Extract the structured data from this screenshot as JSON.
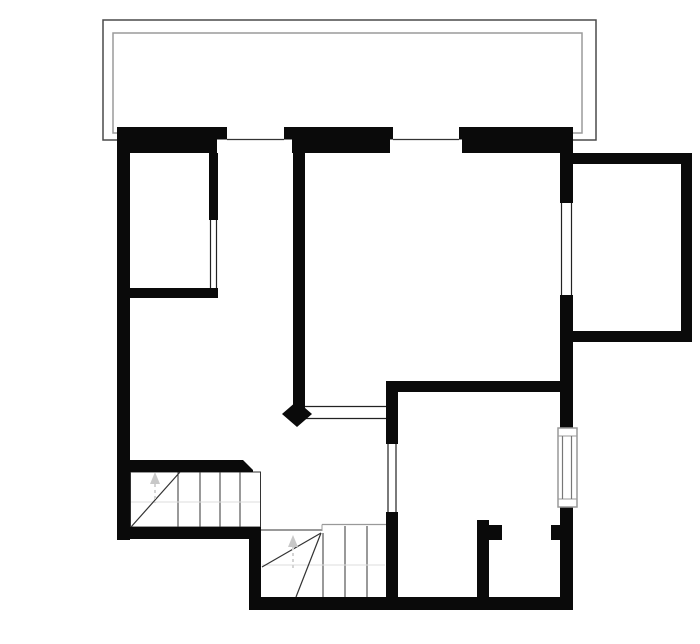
{
  "canvas": {
    "width": 700,
    "height": 644,
    "background": "#ffffff"
  },
  "colors": {
    "wall": "#0a0a0a",
    "balcony_outer": "#4a4a4a",
    "balcony_inner": "#9a9a9a",
    "stair_line": "#333333",
    "stair_faint": "#dddddd",
    "arrow": "#c8c8c8",
    "window_line": "#222222",
    "window_frame": "#999999",
    "glass": "#777777",
    "white": "#ffffff"
  },
  "floorplan": {
    "shapes": [
      {
        "t": "rect",
        "name": "balcony-outer-line",
        "x": 103,
        "y": 20,
        "w": 493,
        "h": 120,
        "stroke": "#4a4a4a",
        "sw": 1.5
      },
      {
        "t": "rect",
        "name": "balcony-inner-line",
        "x": 113,
        "y": 33,
        "w": 469,
        "h": 100,
        "stroke": "#9a9a9a",
        "sw": 1.5
      },
      {
        "t": "rect",
        "name": "stair-upper-outline",
        "x": 130.5,
        "y": 472,
        "w": 130,
        "h": 55,
        "stroke": "#333333",
        "sw": 1
      },
      {
        "t": "line",
        "name": "stair-upper-tread-1",
        "x1": 178,
        "y1": 472,
        "x2": 178,
        "y2": 527,
        "stroke": "#333333",
        "sw": 1
      },
      {
        "t": "line",
        "name": "stair-upper-tread-2",
        "x1": 200,
        "y1": 472,
        "x2": 200,
        "y2": 527,
        "stroke": "#333333",
        "sw": 1
      },
      {
        "t": "line",
        "name": "stair-upper-tread-3",
        "x1": 220,
        "y1": 472,
        "x2": 220,
        "y2": 527,
        "stroke": "#333333",
        "sw": 1
      },
      {
        "t": "line",
        "name": "stair-upper-tread-4",
        "x1": 240,
        "y1": 472,
        "x2": 240,
        "y2": 527,
        "stroke": "#333333",
        "sw": 1
      },
      {
        "t": "line",
        "name": "stair-upper-faint-line",
        "x1": 131,
        "y1": 502,
        "x2": 260,
        "y2": 502,
        "stroke": "#dddddd",
        "sw": 1
      },
      {
        "t": "line",
        "name": "stair-upper-winder-line",
        "x1": 131,
        "y1": 527,
        "x2": 180,
        "y2": 472,
        "stroke": "#333333",
        "sw": 1.2
      },
      {
        "t": "poly",
        "name": "stair-upper-direction-arrow-icon",
        "points": "155,472 150,484 160,484",
        "fill": "#c8c8c8"
      },
      {
        "t": "line",
        "name": "stair-upper-arrow-stem",
        "x1": 155,
        "y1": 484,
        "x2": 155,
        "y2": 503,
        "stroke": "#d4d4d4",
        "sw": 2,
        "dash": "3 3"
      },
      {
        "t": "line",
        "name": "stair-lower-top-edge-left",
        "x1": 261,
        "y1": 530,
        "x2": 322,
        "y2": 530,
        "stroke": "#333333",
        "sw": 1
      },
      {
        "t": "line",
        "name": "stair-lower-top-edge-right",
        "x1": 322,
        "y1": 524.5,
        "x2": 386,
        "y2": 524.5,
        "stroke": "#999999",
        "sw": 1.2
      },
      {
        "t": "line",
        "name": "stair-lower-top-step",
        "x1": 322,
        "y1": 524.5,
        "x2": 322,
        "y2": 531,
        "stroke": "#999999",
        "sw": 1
      },
      {
        "t": "line",
        "name": "stair-lower-tread-1",
        "x1": 323,
        "y1": 533,
        "x2": 323,
        "y2": 597,
        "stroke": "#333333",
        "sw": 1
      },
      {
        "t": "line",
        "name": "stair-lower-tread-2",
        "x1": 345,
        "y1": 526,
        "x2": 345,
        "y2": 597,
        "stroke": "#333333",
        "sw": 1
      },
      {
        "t": "line",
        "name": "stair-lower-tread-3",
        "x1": 367,
        "y1": 526,
        "x2": 367,
        "y2": 597,
        "stroke": "#333333",
        "sw": 1
      },
      {
        "t": "line",
        "name": "stair-lower-faint-line",
        "x1": 262,
        "y1": 565,
        "x2": 385,
        "y2": 565,
        "stroke": "#dddddd",
        "sw": 1
      },
      {
        "t": "line",
        "name": "stair-lower-winder-line-1",
        "x1": 321,
        "y1": 533,
        "x2": 262,
        "y2": 567,
        "stroke": "#333333",
        "sw": 1.2
      },
      {
        "t": "line",
        "name": "stair-lower-winder-line-2",
        "x1": 321,
        "y1": 533,
        "x2": 296,
        "y2": 597,
        "stroke": "#333333",
        "sw": 1.2
      },
      {
        "t": "poly",
        "name": "stair-lower-direction-arrow-icon",
        "points": "293,535 288,547 298,547",
        "fill": "#c8c8c8"
      },
      {
        "t": "line",
        "name": "stair-lower-arrow-stem",
        "x1": 293,
        "y1": 547,
        "x2": 293,
        "y2": 571,
        "stroke": "#d4d4d4",
        "sw": 2,
        "dash": "3 3"
      },
      {
        "t": "rect",
        "name": "wall-top-exterior",
        "x": 117,
        "y": 127,
        "w": 456,
        "h": 26,
        "fill": "#0a0a0a"
      },
      {
        "t": "rect",
        "name": "wall-left-exterior",
        "x": 117,
        "y": 127,
        "w": 13,
        "h": 413,
        "fill": "#0a0a0a"
      },
      {
        "t": "rect",
        "name": "wall-room1-right",
        "x": 209,
        "y": 153,
        "w": 9,
        "h": 67,
        "fill": "#0a0a0a"
      },
      {
        "t": "rect",
        "name": "wall-room1-bottom",
        "x": 128,
        "y": 288,
        "w": 90,
        "h": 10,
        "fill": "#0a0a0a"
      },
      {
        "t": "rect",
        "name": "wall-middle-vertical",
        "x": 293,
        "y": 153,
        "w": 12,
        "h": 255,
        "fill": "#0a0a0a"
      },
      {
        "t": "poly",
        "name": "wall-stair-top",
        "points": "117,460 243,460 253,470 253,472 117,472",
        "fill": "#0a0a0a"
      },
      {
        "t": "rect",
        "name": "wall-lowerleft-horizontal",
        "x": 117,
        "y": 527,
        "w": 144,
        "h": 12,
        "fill": "#0a0a0a"
      },
      {
        "t": "rect",
        "name": "wall-lowerleft-vertical",
        "x": 249,
        "y": 527,
        "w": 12,
        "h": 83,
        "fill": "#0a0a0a"
      },
      {
        "t": "rect",
        "name": "wall-bottom-exterior",
        "x": 249,
        "y": 597,
        "w": 324,
        "h": 13,
        "fill": "#0a0a0a"
      },
      {
        "t": "rect",
        "name": "wall-bedroom-top",
        "x": 386,
        "y": 381,
        "w": 187,
        "h": 11,
        "fill": "#0a0a0a"
      },
      {
        "t": "rect",
        "name": "wall-bedroom-left-upper",
        "x": 386,
        "y": 381,
        "w": 12,
        "h": 63,
        "fill": "#0a0a0a"
      },
      {
        "t": "rect",
        "name": "wall-bedroom-left-lower",
        "x": 386,
        "y": 512,
        "w": 12,
        "h": 98,
        "fill": "#0a0a0a"
      },
      {
        "t": "rect",
        "name": "wall-right-upper",
        "x": 560,
        "y": 127,
        "w": 13,
        "h": 76,
        "fill": "#0a0a0a"
      },
      {
        "t": "rect",
        "name": "wall-right-middle",
        "x": 560,
        "y": 295,
        "w": 13,
        "h": 133,
        "fill": "#0a0a0a"
      },
      {
        "t": "rect",
        "name": "wall-right-lower",
        "x": 560,
        "y": 507,
        "w": 13,
        "h": 103,
        "fill": "#0a0a0a"
      },
      {
        "t": "rect",
        "name": "wall-right-door-stub",
        "x": 551,
        "y": 525,
        "w": 9,
        "h": 15,
        "fill": "#0a0a0a"
      },
      {
        "t": "rect",
        "name": "wall-partition",
        "x": 477,
        "y": 520,
        "w": 12,
        "h": 77,
        "fill": "#0a0a0a"
      },
      {
        "t": "rect",
        "name": "wall-partition-cap",
        "x": 489,
        "y": 525,
        "w": 13,
        "h": 15,
        "fill": "#0a0a0a"
      },
      {
        "t": "rect",
        "name": "wall-bay-top",
        "x": 573,
        "y": 153,
        "w": 119,
        "h": 11,
        "fill": "#0a0a0a"
      },
      {
        "t": "rect",
        "name": "wall-bay-right",
        "x": 681,
        "y": 153,
        "w": 11,
        "h": 189,
        "fill": "#0a0a0a"
      },
      {
        "t": "rect",
        "name": "wall-bay-bottom",
        "x": 573,
        "y": 331,
        "w": 119,
        "h": 11,
        "fill": "#0a0a0a"
      },
      {
        "t": "rect",
        "name": "window-top-left-outer-cut",
        "x": 227,
        "y": 127,
        "w": 57,
        "h": 12.5,
        "fill": "#ffffff"
      },
      {
        "t": "rect",
        "name": "window-top-left-inner-cut",
        "x": 217,
        "y": 139.5,
        "w": 75,
        "h": 13.5,
        "fill": "#ffffff"
      },
      {
        "t": "line",
        "name": "window-top-left-sill",
        "x1": 227,
        "y1": 139.5,
        "x2": 284,
        "y2": 139.5,
        "stroke": "#333333",
        "sw": 1.2
      },
      {
        "t": "rect",
        "name": "window-top-mid-outer-cut",
        "x": 393,
        "y": 127,
        "w": 66,
        "h": 12.5,
        "fill": "#ffffff"
      },
      {
        "t": "rect",
        "name": "window-top-mid-inner-cut",
        "x": 390,
        "y": 139.5,
        "w": 72,
        "h": 13.5,
        "fill": "#ffffff"
      },
      {
        "t": "line",
        "name": "window-top-mid-sill",
        "x1": 393,
        "y1": 139.5,
        "x2": 459,
        "y2": 139.5,
        "stroke": "#333333",
        "sw": 1.2
      },
      {
        "t": "rect",
        "name": "window-room1-cut",
        "x": 209,
        "y": 220,
        "w": 9,
        "h": 68,
        "fill": "#ffffff"
      },
      {
        "t": "line",
        "name": "window-room1-line-left",
        "x1": 210.5,
        "y1": 220,
        "x2": 210.5,
        "y2": 288,
        "stroke": "#222222",
        "sw": 1.2
      },
      {
        "t": "line",
        "name": "window-room1-line-right",
        "x1": 216.5,
        "y1": 220,
        "x2": 216.5,
        "y2": 288,
        "stroke": "#222222",
        "sw": 1.2
      },
      {
        "t": "rect",
        "name": "window-right-upper-cut",
        "x": 560,
        "y": 203,
        "w": 13,
        "h": 92,
        "fill": "#ffffff"
      },
      {
        "t": "line",
        "name": "window-right-upper-line-left",
        "x1": 561.5,
        "y1": 203,
        "x2": 561.5,
        "y2": 295,
        "stroke": "#222222",
        "sw": 1.2
      },
      {
        "t": "line",
        "name": "window-right-upper-line-right",
        "x1": 571.5,
        "y1": 203,
        "x2": 571.5,
        "y2": 295,
        "stroke": "#222222",
        "sw": 1.2
      },
      {
        "t": "rect",
        "name": "hall-opening-cut",
        "x": 305,
        "y": 405.5,
        "w": 81,
        "h": 14,
        "fill": "#ffffff"
      },
      {
        "t": "line",
        "name": "hall-opening-line-top",
        "x1": 305,
        "y1": 406.5,
        "x2": 386,
        "y2": 406.5,
        "stroke": "#222222",
        "sw": 1.2
      },
      {
        "t": "line",
        "name": "hall-opening-line-bottom",
        "x1": 305,
        "y1": 418.5,
        "x2": 386,
        "y2": 418.5,
        "stroke": "#222222",
        "sw": 1.2
      },
      {
        "t": "rect",
        "name": "window-bedroom-left-cut",
        "x": 386,
        "y": 444,
        "w": 12,
        "h": 68,
        "fill": "#ffffff"
      },
      {
        "t": "line",
        "name": "window-bedroom-left-line-a",
        "x1": 388,
        "y1": 444,
        "x2": 388,
        "y2": 512,
        "stroke": "#222222",
        "sw": 1.2
      },
      {
        "t": "line",
        "name": "window-bedroom-left-line-b",
        "x1": 396,
        "y1": 444,
        "x2": 396,
        "y2": 512,
        "stroke": "#222222",
        "sw": 1.2
      },
      {
        "t": "rect",
        "name": "window-right-lower-frame",
        "x": 558,
        "y": 428,
        "w": 19,
        "h": 79,
        "fill": "#ffffff",
        "stroke": "#999999",
        "sw": 1.5
      },
      {
        "t": "line",
        "name": "window-right-lower-cap-top",
        "x1": 558,
        "y1": 436,
        "x2": 577,
        "y2": 436,
        "stroke": "#999999",
        "sw": 1
      },
      {
        "t": "line",
        "name": "window-right-lower-cap-bottom",
        "x1": 558,
        "y1": 499,
        "x2": 577,
        "y2": 499,
        "stroke": "#999999",
        "sw": 1
      },
      {
        "t": "line",
        "name": "window-right-lower-glass-left",
        "x1": 562.5,
        "y1": 436,
        "x2": 562.5,
        "y2": 499,
        "stroke": "#777777",
        "sw": 1.2
      },
      {
        "t": "line",
        "name": "window-right-lower-glass-right",
        "x1": 571.5,
        "y1": 436,
        "x2": 571.5,
        "y2": 499,
        "stroke": "#777777",
        "sw": 1.2
      },
      {
        "t": "poly",
        "name": "door-leaf-diamond",
        "points": "297,401 312,414 297,427 282,414",
        "fill": "#0a0a0a"
      }
    ]
  }
}
